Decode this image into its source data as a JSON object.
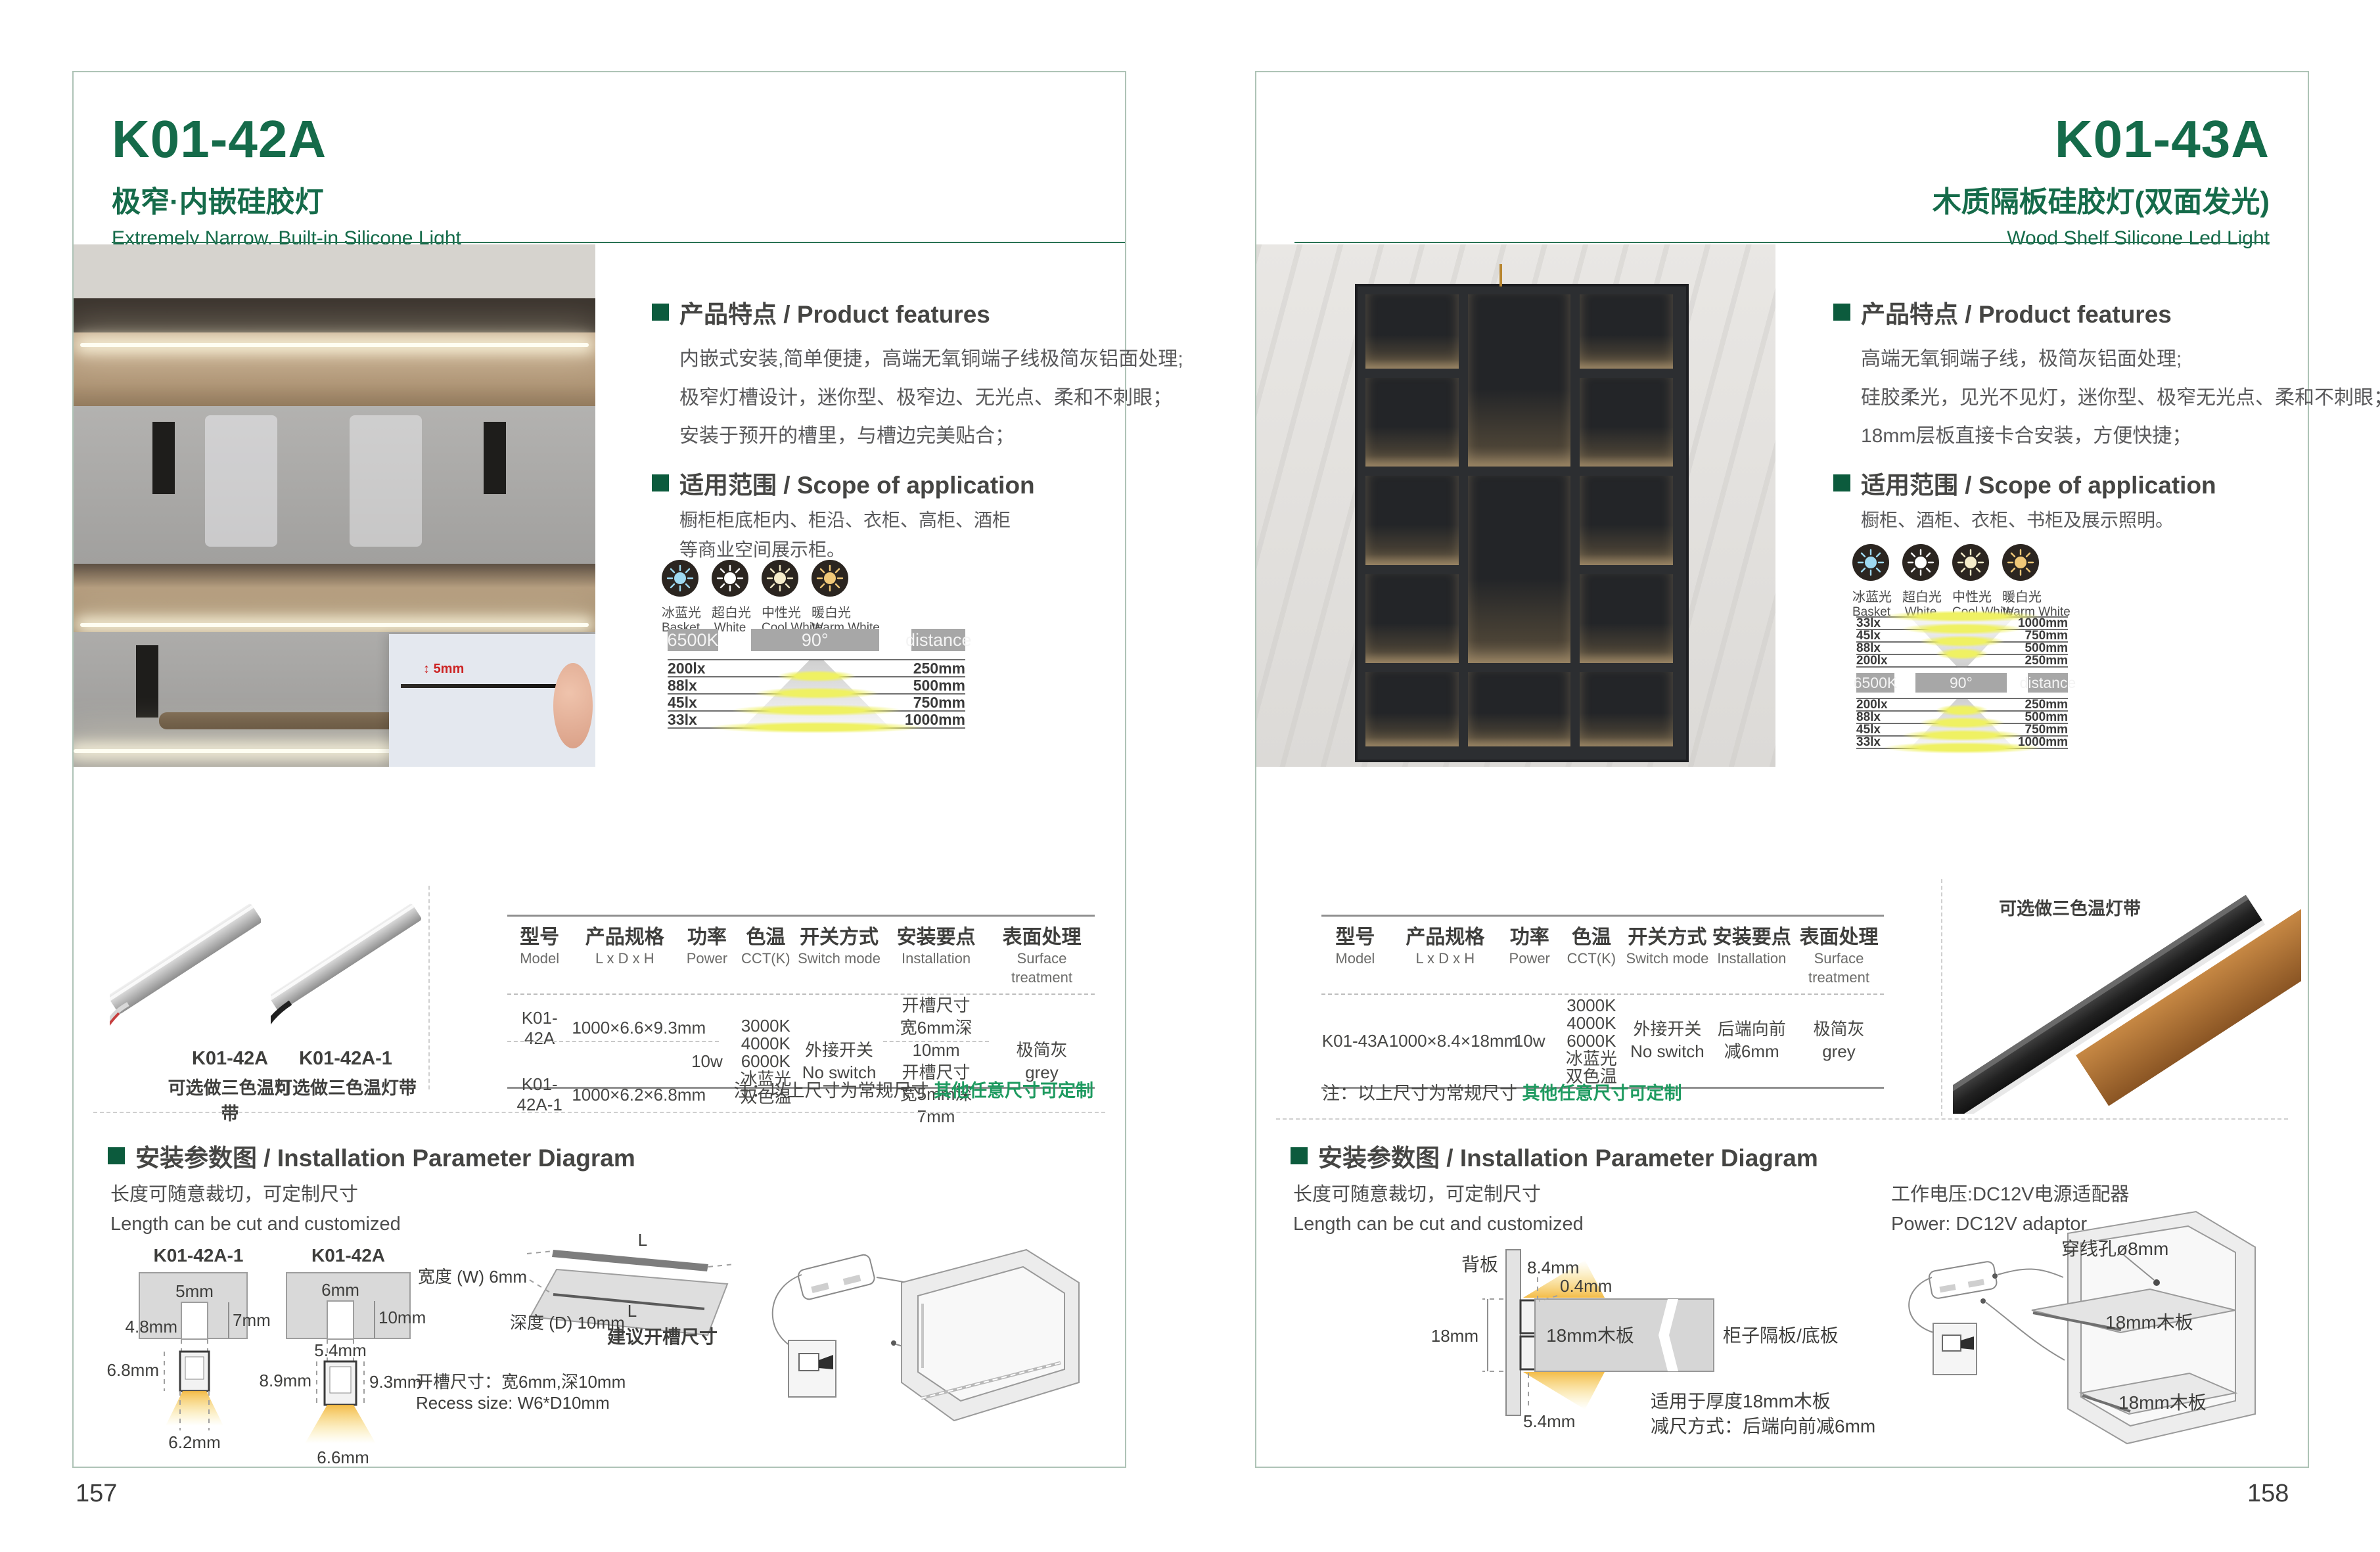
{
  "page_left": {
    "page_number": "157",
    "model": "K01-42A",
    "title_cn": "极窄·内嵌硅胶灯",
    "title_en": "Extremely Narrow. Built-in Silicone Light",
    "photo": {
      "dim": "5mm"
    },
    "features": {
      "heading": "产品特点 / Product features",
      "lines": [
        "内嵌式安装,简单便捷，高端无氧铜端子线极简灰铝面处理;",
        "极窄灯槽设计，迷你型、极窄边、无光点、柔和不刺眼；",
        "安装于预开的槽里，与槽边完美贴合；"
      ]
    },
    "scope": {
      "heading": "适用范围 / Scope of application",
      "lines": [
        "橱柜柜底柜内、柜沿、衣柜、高柜、酒柜",
        "等商业空间展示柜。"
      ]
    },
    "light_options": [
      {
        "cn": "冰蓝光",
        "en": "Basket",
        "color": "#9ed9f1"
      },
      {
        "cn": "超白光",
        "en": "White",
        "color": "#ffffff"
      },
      {
        "cn": "中性光",
        "en": "Cool White",
        "color": "#f5ecca"
      },
      {
        "cn": "暖白光",
        "en": "Warm White",
        "color": "#f0c878"
      }
    ],
    "chart": {
      "cct": "6500K",
      "beam_angle": "90°",
      "distance_label": "distance",
      "rows": [
        {
          "lux": "200lx",
          "distance": "250mm"
        },
        {
          "lux": "88lx",
          "distance": "500mm"
        },
        {
          "lux": "45lx",
          "distance": "750mm"
        },
        {
          "lux": "33lx",
          "distance": "1000mm"
        }
      ]
    },
    "products": [
      {
        "model": "K01-42A",
        "note": "可选做三色温灯带"
      },
      {
        "model": "K01-42A-1",
        "note": "可选做三色温灯带"
      }
    ],
    "table": {
      "headers": [
        {
          "cn": "型号",
          "en": "Model"
        },
        {
          "cn": "产品规格",
          "en": "L x D x H"
        },
        {
          "cn": "功率",
          "en": "Power"
        },
        {
          "cn": "色温",
          "en": "CCT(K)"
        },
        {
          "cn": "开关方式",
          "en": "Switch mode"
        },
        {
          "cn": "安装要点",
          "en": "Installation"
        },
        {
          "cn": "表面处理",
          "en": "Surface treatment"
        }
      ],
      "models": [
        "K01-42A",
        "K01-42A-1"
      ],
      "specs": [
        "1000×6.6×9.3mm",
        "1000×6.2×6.8mm"
      ],
      "power": "10w",
      "cct": [
        "3000K",
        "4000K",
        "6000K",
        "冰蓝光",
        "双色温"
      ],
      "switch": [
        "外接开关",
        "No switch"
      ],
      "install": [
        [
          "开槽尺寸",
          "宽6mm深10mm"
        ],
        [
          "开槽尺寸",
          "宽5mm深7mm"
        ]
      ],
      "surface": [
        "极简灰",
        "grey"
      ]
    },
    "note": {
      "prefix": "注：以上尺寸为常规尺寸 ",
      "highlight": "其他任意尺寸可定制"
    },
    "install": {
      "heading": "安装参数图 / Installation Parameter Diagram",
      "cut_cn": "长度可随意裁切，可定制尺寸",
      "cut_en": "Length can be cut and customized",
      "d1": {
        "model": "K01-42A-1",
        "top": "5mm",
        "depth": "7mm",
        "inner": "4.8mm",
        "height": "6.8mm",
        "bottom": "6.2mm"
      },
      "d2": {
        "model": "K01-42A",
        "top": "6mm",
        "depth": "10mm",
        "inner": "5.4mm",
        "left": "8.9mm",
        "right": "9.3mm",
        "bottom": "6.6mm"
      },
      "board": {
        "width_label": "宽度 (W) 6mm",
        "depth_label": "深度 (D) 10mm",
        "caption": "建议开槽尺寸",
        "l": "L"
      },
      "recess_cn": "开槽尺寸：宽6mm,深10mm",
      "recess_en": "Recess size: W6*D10mm"
    }
  },
  "page_right": {
    "page_number": "158",
    "model": "K01-43A",
    "title_cn": "木质隔板硅胶灯(双面发光)",
    "title_en": "Wood Shelf Silicone Led Light",
    "features": {
      "heading": "产品特点 / Product features",
      "lines": [
        "高端无氧铜端子线，极简灰铝面处理;",
        "硅胶柔光，见光不见灯，迷你型、极窄无光点、柔和不刺眼；",
        "18mm层板直接卡合安装，方便快捷；"
      ]
    },
    "scope": {
      "heading": "适用范围 / Scope of application",
      "lines": [
        "橱柜、酒柜、衣柜、书柜及展示照明。"
      ]
    },
    "light_options": [
      {
        "cn": "冰蓝光",
        "en": "Basket",
        "color": "#9ed9f1"
      },
      {
        "cn": "超白光",
        "en": "White",
        "color": "#ffffff"
      },
      {
        "cn": "中性光",
        "en": "Cool White",
        "color": "#f5ecca"
      },
      {
        "cn": "暖白光",
        "en": "Warm White",
        "color": "#f0c878"
      }
    ],
    "chart": {
      "cct": "6500K",
      "beam_angle": "90°",
      "distance_label": "distance",
      "rows_top": [
        {
          "lux": "33lx",
          "distance": "1000mm"
        },
        {
          "lux": "45lx",
          "distance": "750mm"
        },
        {
          "lux": "88lx",
          "distance": "500mm"
        },
        {
          "lux": "200lx",
          "distance": "250mm"
        }
      ],
      "rows_bottom": [
        {
          "lux": "200lx",
          "distance": "250mm"
        },
        {
          "lux": "88lx",
          "distance": "500mm"
        },
        {
          "lux": "45lx",
          "distance": "750mm"
        },
        {
          "lux": "33lx",
          "distance": "1000mm"
        }
      ]
    },
    "product_note": "可选做三色温灯带",
    "table": {
      "headers": [
        {
          "cn": "型号",
          "en": "Model"
        },
        {
          "cn": "产品规格",
          "en": "L x D x H"
        },
        {
          "cn": "功率",
          "en": "Power"
        },
        {
          "cn": "色温",
          "en": "CCT(K)"
        },
        {
          "cn": "开关方式",
          "en": "Switch mode"
        },
        {
          "cn": "安装要点",
          "en": "Installation"
        },
        {
          "cn": "表面处理",
          "en": "Surface treatment"
        }
      ],
      "model": "K01-43A",
      "spec": "1000×8.4×18mm",
      "power": "10w",
      "cct": [
        "3000K",
        "4000K",
        "6000K",
        "冰蓝光",
        "双色温"
      ],
      "switch": [
        "外接开关",
        "No switch"
      ],
      "install": [
        "后端向前",
        "减6mm"
      ],
      "surface": [
        "极简灰",
        "grey"
      ]
    },
    "note": {
      "prefix": "注：以上尺寸为常规尺寸 ",
      "highlight": "其他任意尺寸可定制"
    },
    "install": {
      "heading": "安装参数图 / Installation Parameter Diagram",
      "cut_cn": "长度可随意裁切，可定制尺寸",
      "cut_en": "Length can be cut and customized",
      "power_cn": "工作电压:DC12V电源适配器",
      "power_en": "Power: DC12V adaptor",
      "back": "背板",
      "d84": "8.4mm",
      "d04": "0.4mm",
      "d18": "18mm",
      "board": "18mm木板",
      "shelf_label": "柜子隔板/底板",
      "d54": "5.4mm",
      "fit": "适用于厚度18mm木板",
      "reduce": "减尺方式：后端向前减6mm",
      "hole": "穿线孔ø8mm",
      "board1": "18mm木板",
      "board2": "18mm木板"
    }
  }
}
